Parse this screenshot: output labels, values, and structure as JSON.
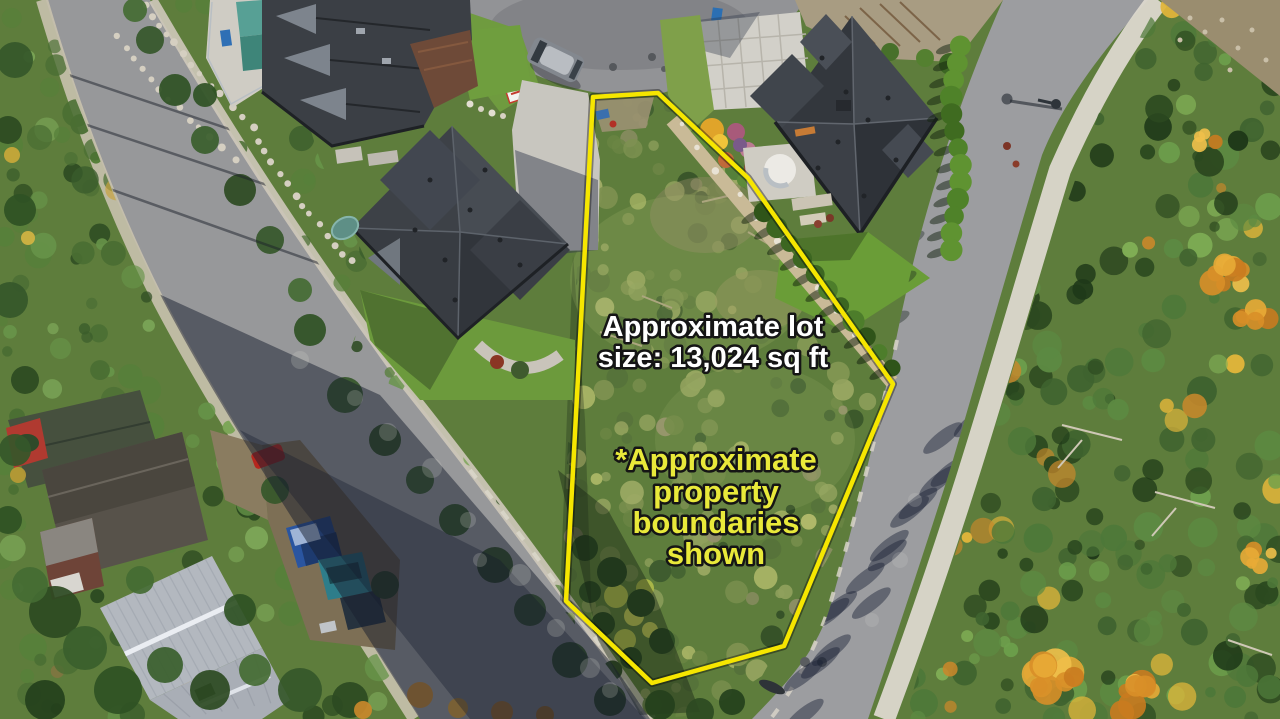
{
  "image": {
    "kind": "aerial-drone-photo",
    "description": "Aerial view of a vacant treed building lot between two residential roads, with neighbouring houses, a cul-de-sac and autumn forest",
    "colors": {
      "boundary_line": "#f6e600",
      "lot_size_text": "#ffffff",
      "disclaimer_text": "#e9e93a",
      "text_outline": "#151515"
    }
  },
  "annotations": {
    "lot_size": {
      "line1": "Approximate lot",
      "line2": "size: 13,024 sq ft"
    },
    "disclaimer": {
      "line1": "*Approximate",
      "line2": "property",
      "line3": "boundaries",
      "line4": "shown"
    }
  },
  "lot": {
    "size_label_value": "13,024 sq ft",
    "boundary_points": "593,97 658,93 748,178 893,384 784,646 652,683 566,601"
  }
}
